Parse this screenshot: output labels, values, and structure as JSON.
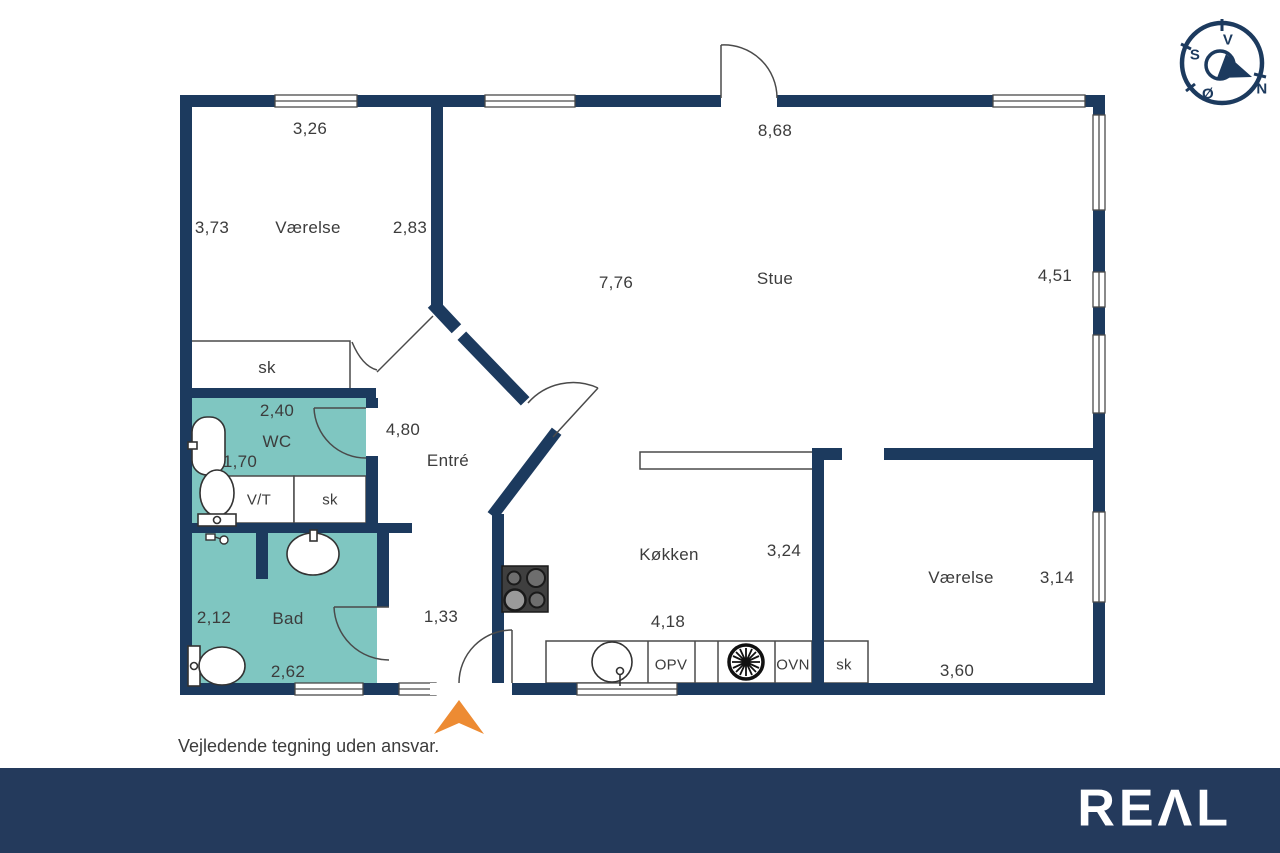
{
  "colors": {
    "navy": "#1c3a5e",
    "footerNavy": "#243a5c",
    "teal": "#7fc6c1",
    "orange": "#ed8b33",
    "line": "#4a4a4a",
    "text": "#3c3c3c"
  },
  "plan": {
    "disclaimer": "Vejledende tegning uden ansvar.",
    "labels": [
      {
        "name": "dim-vaerelse1-top",
        "t": "3,26",
        "x": 310,
        "y": 129
      },
      {
        "name": "room-vaerelse1",
        "t": "Værelse",
        "x": 308,
        "y": 228
      },
      {
        "name": "dim-vaerelse1-left",
        "t": "3,73",
        "x": 212,
        "y": 228
      },
      {
        "name": "dim-vaerelse1-right",
        "t": "2,83",
        "x": 410,
        "y": 228
      },
      {
        "name": "closet-vaerelse1-sk",
        "t": "sk",
        "x": 267,
        "y": 368
      },
      {
        "name": "dim-stue-top",
        "t": "8,68",
        "x": 775,
        "y": 131
      },
      {
        "name": "room-stue",
        "t": "Stue",
        "x": 775,
        "y": 279
      },
      {
        "name": "dim-stue-left",
        "t": "7,76",
        "x": 616,
        "y": 283
      },
      {
        "name": "dim-stue-right",
        "t": "4,51",
        "x": 1055,
        "y": 276
      },
      {
        "name": "dim-wc-top",
        "t": "2,40",
        "x": 277,
        "y": 411
      },
      {
        "name": "room-wc",
        "t": "WC",
        "x": 277,
        "y": 442
      },
      {
        "name": "dim-wc-left",
        "t": "1,70",
        "x": 240,
        "y": 462
      },
      {
        "name": "closet-vt",
        "t": "V/T",
        "x": 259,
        "y": 500,
        "cls": "small"
      },
      {
        "name": "closet-wc-sk",
        "t": "sk",
        "x": 330,
        "y": 500,
        "cls": "small"
      },
      {
        "name": "dim-entre",
        "t": "4,80",
        "x": 403,
        "y": 430
      },
      {
        "name": "room-entre",
        "t": "Entré",
        "x": 448,
        "y": 461
      },
      {
        "name": "dim-bad-left",
        "t": "2,12",
        "x": 214,
        "y": 618
      },
      {
        "name": "room-bad",
        "t": "Bad",
        "x": 288,
        "y": 619
      },
      {
        "name": "dim-bad-bottom",
        "t": "2,62",
        "x": 288,
        "y": 672
      },
      {
        "name": "dim-entre-width",
        "t": "1,33",
        "x": 441,
        "y": 617
      },
      {
        "name": "room-koekken",
        "t": "Køkken",
        "x": 669,
        "y": 555
      },
      {
        "name": "dim-koekken-right",
        "t": "3,24",
        "x": 784,
        "y": 551
      },
      {
        "name": "dim-koekken-bottom",
        "t": "4,18",
        "x": 668,
        "y": 622
      },
      {
        "name": "appliance-opv",
        "t": "OPV",
        "x": 671,
        "y": 665,
        "cls": "small"
      },
      {
        "name": "appliance-ovn",
        "t": "OVN",
        "x": 793,
        "y": 665,
        "cls": "small"
      },
      {
        "name": "closet-koekken-sk",
        "t": "sk",
        "x": 844,
        "y": 665,
        "cls": "small"
      },
      {
        "name": "room-vaerelse2",
        "t": "Værelse",
        "x": 961,
        "y": 578
      },
      {
        "name": "dim-vaerelse2-right",
        "t": "3,14",
        "x": 1057,
        "y": 578
      },
      {
        "name": "dim-vaerelse2-bottom",
        "t": "3,60",
        "x": 957,
        "y": 671
      }
    ],
    "compass_letters": [
      {
        "name": "compass-letter-v",
        "t": "V",
        "x": 1228,
        "y": 40,
        "cls": "compass-letter"
      },
      {
        "name": "compass-letter-s",
        "t": "S",
        "x": 1195,
        "y": 55,
        "cls": "compass-letter"
      },
      {
        "name": "compass-letter-n",
        "t": "N",
        "x": 1262,
        "y": 89,
        "cls": "compass-letter"
      },
      {
        "name": "compass-letter-oe",
        "t": "Ø",
        "x": 1208,
        "y": 94,
        "cls": "compass-letter"
      }
    ]
  },
  "footer": {
    "logo": "REΛL"
  }
}
